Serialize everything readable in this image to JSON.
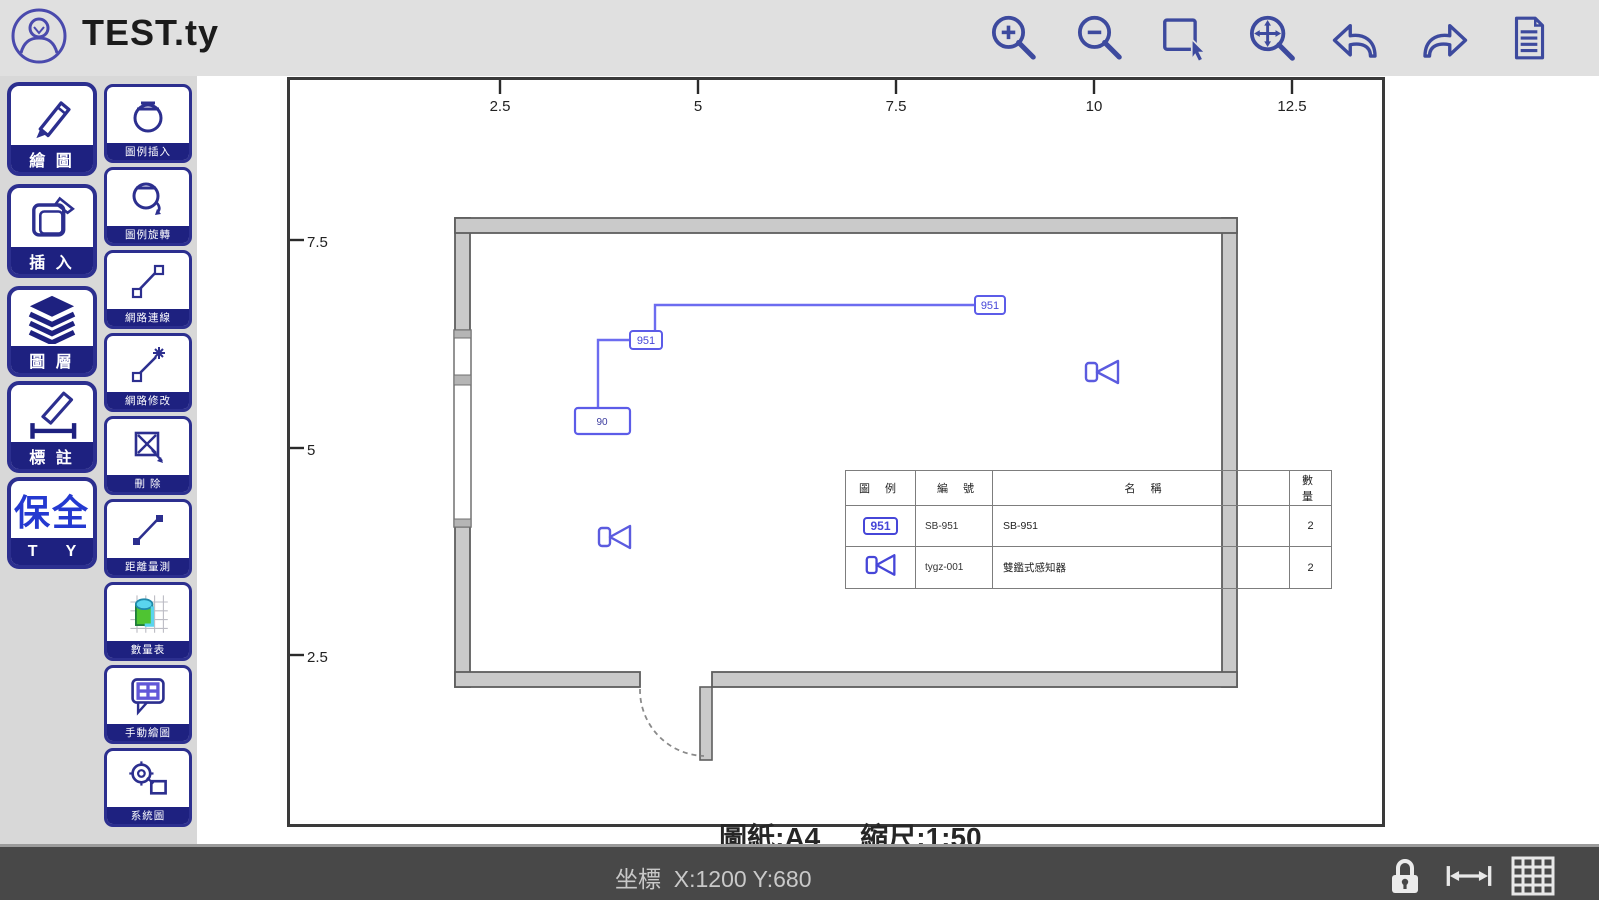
{
  "window": {
    "title": "TEST.ty"
  },
  "sidebar": {
    "main_tools": [
      {
        "label": "繪 圖"
      },
      {
        "label": "插 入"
      },
      {
        "label": "圖 層"
      },
      {
        "label": "標 註"
      },
      {
        "label": "T Y",
        "text": "保全"
      }
    ],
    "secondary_tools": [
      {
        "label": "圖例插入"
      },
      {
        "label": "圖例旋轉"
      },
      {
        "label": "網路連線"
      },
      {
        "label": "網路修改"
      },
      {
        "label": "刪 除"
      },
      {
        "label": "距離量測"
      },
      {
        "label": "數量表"
      },
      {
        "label": "手動繪圖"
      },
      {
        "label": "系統圖"
      }
    ]
  },
  "canvas": {
    "ruler_top": [
      "2.5",
      "5",
      "7.5",
      "10",
      "12.5"
    ],
    "ruler_left": [
      "7.5",
      "5",
      "2.5"
    ],
    "caption_paper": "圖紙:A4",
    "caption_scale": "縮尺:1:50",
    "wire_labels": {
      "box1": "951",
      "box2": "951",
      "panel": "90"
    }
  },
  "legend_table": {
    "headers": [
      "圖 例",
      "編 號",
      "名 稱",
      "數 量"
    ],
    "rows": [
      {
        "symbol_label": "951",
        "code": "SB-951",
        "name": "SB-951",
        "qty": "2"
      },
      {
        "symbol_label": "bowtie",
        "code": "tygz-001",
        "name": "雙鑑式感知器",
        "qty": "2"
      }
    ]
  },
  "statusbar": {
    "text": "坐標  X:1200 Y:680"
  },
  "colors": {
    "accent_blue": "#3d4a9e",
    "wire_blue": "#6c6cf0",
    "band_blue": "#1e2180",
    "wall_gray": "#cacaca"
  }
}
